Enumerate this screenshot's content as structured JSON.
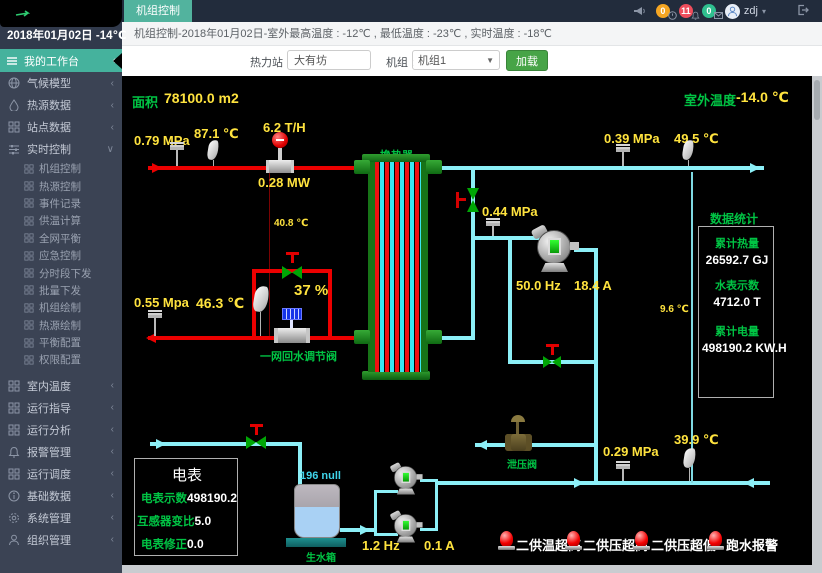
{
  "topbar": {
    "tab": "机组控制",
    "notif_time": "0",
    "notif_alarm": "11",
    "notif_msg": "0",
    "user": "zdj"
  },
  "sidebar": {
    "date": "2018年01月02日 -14℃",
    "workbench": "我的工作台",
    "menu_top": [
      {
        "label": "气候模型"
      },
      {
        "label": "热源数据"
      },
      {
        "label": "站点数据"
      },
      {
        "label": "实时控制"
      }
    ],
    "submenu": [
      "机组控制",
      "热源控制",
      "事件记录",
      "供温计算",
      "全网平衡",
      "应急控制",
      "分时段下发",
      "批量下发",
      "机组绘制",
      "热源绘制",
      "平衡配置",
      "权限配置"
    ],
    "menu_bottom": [
      "室内温度",
      "运行指导",
      "运行分析",
      "报警管理",
      "运行调度",
      "基础数据",
      "系统管理",
      "组织管理"
    ]
  },
  "header": {
    "info": "机组控制-2018年01月02日-室外最高温度 : -12℃ , 最低温度 : -23℃ , 实时温度 : -18℃"
  },
  "filter": {
    "station_label": "热力站 :",
    "station_value": "大有坊",
    "unit_label": "机组 :",
    "unit_value": "机组1",
    "load": "加载"
  },
  "scada": {
    "area_label": "面积",
    "area_value": "78100.0 m2",
    "outdoor_label": "室外温度",
    "outdoor_value": "-14.0 ℃",
    "hx_label": "换热器",
    "p1": "0.79 MPa",
    "t1": "87.1 ℃",
    "flow": "6.2 T/H",
    "power": "0.28 MW",
    "p2": "0.39 MPa",
    "t2": "49.5 ℃",
    "t_line": "40.8 ℃",
    "p3": "0.55 Mpa",
    "t3": "46.3 ℃",
    "bypass_pct": "37 %",
    "bypass_valve": "一网回水调节阀",
    "p4": "0.44 MPa",
    "pump_hz": "50.0 Hz",
    "pump_a": "18.4 A",
    "t4": "9.6 ℃",
    "relief": "泄压阀",
    "p5": "0.29 MPa",
    "t5": "39.9 ℃",
    "makeup_hz": "1.2 Hz",
    "makeup_a": "0.1 A",
    "tank_level": "196 null",
    "tank_label": "生水箱",
    "stats": {
      "title": "数据统计",
      "heat_label": "累计热量",
      "heat_value": "26592.7 GJ",
      "water_label": "水表示数",
      "water_value": "4712.0 T",
      "elec_label": "累计电量",
      "elec_value": "498190.2 KW.H"
    },
    "meter": {
      "title": "电表",
      "r1_label": "电表示数",
      "r1_value": "498190.2",
      "r2_label": "互感器变比",
      "r2_value": "5.0",
      "r3_label": "电表修正",
      "r3_value": "0.0"
    },
    "alarms": [
      "二供温超高",
      "二供压超高",
      "二供压超低",
      "跑水报警"
    ]
  }
}
